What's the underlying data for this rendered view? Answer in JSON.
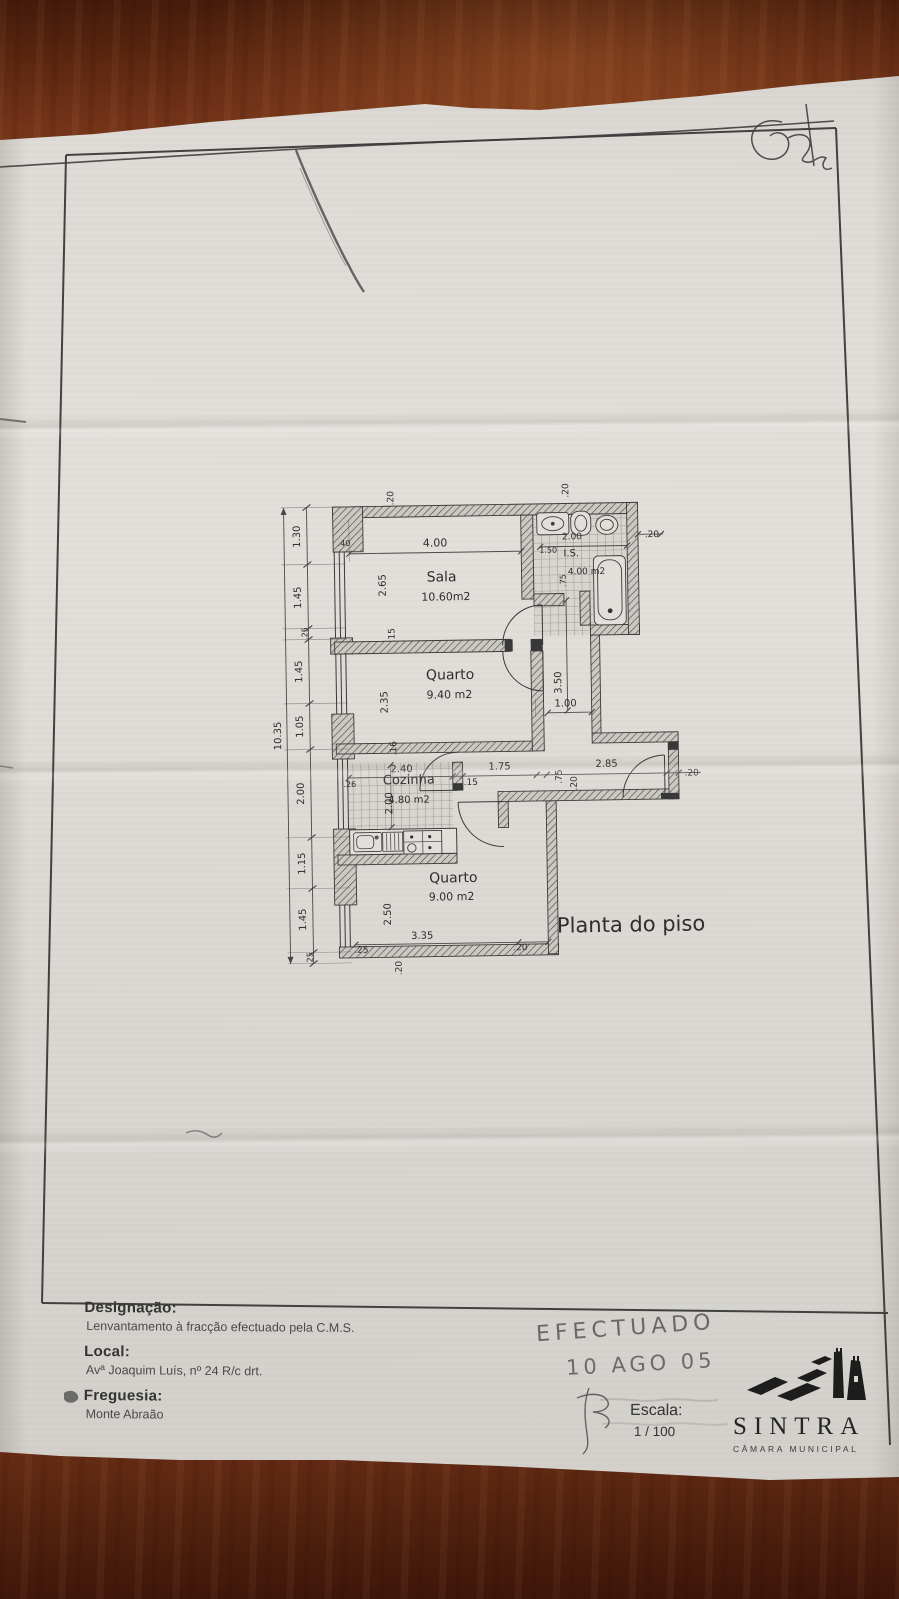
{
  "plan": {
    "title": "Planta do piso",
    "rooms": [
      {
        "name": "Sala",
        "area": "10.60m2"
      },
      {
        "name": "Quarto",
        "area": "9.40 m2"
      },
      {
        "name": "I.S.",
        "area": "4.00 m2"
      },
      {
        "name": "Cozinha",
        "area": "4.80 m2"
      },
      {
        "name": "Quarto",
        "area": "9.00 m2"
      }
    ],
    "left_dimension_chain": [
      "1.30",
      "1.45",
      ".25",
      "1.45",
      "1.05",
      "2.00",
      "1.15",
      "1.45",
      ".25"
    ],
    "left_total": "10.35",
    "labels": [
      {
        "t": ".20",
        "x": 397,
        "y": 497,
        "r": -90,
        "s": 9
      },
      {
        "t": ".40",
        "x": 347,
        "y": 544,
        "r": 0,
        "s": 8
      },
      {
        "t": "4.00",
        "x": 438,
        "y": 546,
        "r": 0,
        "s": 11
      },
      {
        "t": "2.65",
        "x": 388,
        "y": 584,
        "r": -90,
        "s": 10
      },
      {
        "t": "Sala",
        "x": 444,
        "y": 581,
        "r": 0,
        "s": 14
      },
      {
        "t": "10.60m2",
        "x": 448,
        "y": 600,
        "r": 0,
        "s": 11
      },
      {
        "t": ".15",
        "x": 396,
        "y": 634,
        "r": -90,
        "s": 9
      },
      {
        "t": "Quarto",
        "x": 451,
        "y": 679,
        "r": 0,
        "s": 14
      },
      {
        "t": "9.40 m2",
        "x": 450,
        "y": 698,
        "r": 0,
        "s": 11
      },
      {
        "t": "2.35",
        "x": 388,
        "y": 701,
        "r": -90,
        "s": 10
      },
      {
        "t": ".16",
        "x": 396,
        "y": 747,
        "r": -90,
        "s": 9
      },
      {
        "t": ".20",
        "x": 572,
        "y": 492,
        "r": -90,
        "s": 9
      },
      {
        "t": "2.00",
        "x": 575,
        "y": 541,
        "r": 0,
        "s": 9
      },
      {
        "t": "1.50",
        "x": 551,
        "y": 554,
        "r": 0,
        "s": 8
      },
      {
        "t": "I.S.",
        "x": 574,
        "y": 558,
        "r": 0,
        "s": 10
      },
      {
        "t": "4.00 m2",
        "x": 589,
        "y": 576,
        "r": 0,
        "s": 9
      },
      {
        "t": ".20",
        "x": 655,
        "y": 540,
        "r": 0,
        "s": 9
      },
      {
        "t": ".75",
        "x": 568,
        "y": 582,
        "r": -90,
        "s": 8
      },
      {
        "t": "3.50",
        "x": 562,
        "y": 684,
        "r": -90,
        "s": 10
      },
      {
        "t": "1.00",
        "x": 566,
        "y": 708,
        "r": 0,
        "s": 10
      },
      {
        "t": "2.40",
        "x": 401,
        "y": 771,
        "r": 0,
        "s": 10
      },
      {
        "t": ".26",
        "x": 349,
        "y": 785,
        "r": 0,
        "s": 8
      },
      {
        "t": "Cozinha",
        "x": 408,
        "y": 783,
        "r": 0,
        "s": 13
      },
      {
        "t": "2.00",
        "x": 391,
        "y": 802,
        "r": -90,
        "s": 10
      },
      {
        "t": "4.80 m2",
        "x": 408,
        "y": 802,
        "r": 0,
        "s": 10
      },
      {
        "t": "1.75",
        "x": 499,
        "y": 770,
        "r": 0,
        "s": 10
      },
      {
        "t": ".15",
        "x": 470,
        "y": 785,
        "r": 0,
        "s": 9
      },
      {
        "t": ".75",
        "x": 561,
        "y": 778,
        "r": -90,
        "s": 9
      },
      {
        "t": "2.85",
        "x": 606,
        "y": 769,
        "r": 0,
        "s": 10
      },
      {
        "t": ".20",
        "x": 576,
        "y": 785,
        "r": -90,
        "s": 9
      },
      {
        "t": ".20",
        "x": 691,
        "y": 779,
        "r": 0,
        "s": 9
      },
      {
        "t": "Quarto",
        "x": 451,
        "y": 882,
        "r": 0,
        "s": 14
      },
      {
        "t": "9.00 m2",
        "x": 449,
        "y": 900,
        "r": 0,
        "s": 11
      },
      {
        "t": "2.50",
        "x": 388,
        "y": 913,
        "r": -90,
        "s": 10
      },
      {
        "t": "3.35",
        "x": 419,
        "y": 938,
        "r": 0,
        "s": 10
      },
      {
        "t": ".25",
        "x": 358,
        "y": 951,
        "r": 0,
        "s": 9
      },
      {
        "t": ".20",
        "x": 517,
        "y": 951,
        "r": 0,
        "s": 9
      },
      {
        "t": ".20",
        "x": 398,
        "y": 967,
        "r": -90,
        "s": 9
      },
      {
        "t": "1.30",
        "x": 303,
        "y": 534,
        "r": -90,
        "s": 10
      },
      {
        "t": "1.45",
        "x": 303,
        "y": 595,
        "r": -90,
        "s": 10
      },
      {
        "t": ".25",
        "x": 309,
        "y": 631,
        "r": -90,
        "s": 8
      },
      {
        "t": "1.45",
        "x": 303,
        "y": 669,
        "r": -90,
        "s": 10
      },
      {
        "t": "1.05",
        "x": 303,
        "y": 724,
        "r": -90,
        "s": 10
      },
      {
        "t": "2.00",
        "x": 303,
        "y": 791,
        "r": -90,
        "s": 10
      },
      {
        "t": "1.15",
        "x": 303,
        "y": 861,
        "r": -90,
        "s": 10
      },
      {
        "t": "1.45",
        "x": 303,
        "y": 917,
        "r": -90,
        "s": 10
      },
      {
        "t": ".25",
        "x": 309,
        "y": 956,
        "r": -90,
        "s": 8
      },
      {
        "t": "10.35",
        "x": 281,
        "y": 733,
        "r": -90,
        "s": 10
      },
      {
        "t": "Planta do piso",
        "x": 628,
        "y": 934,
        "r": 0,
        "s": 21
      }
    ]
  },
  "titleblock": {
    "designacao_label": "Designação:",
    "designacao_value": "Lenvantamento à fracção efectuado pela C.M.S.",
    "local_label": "Local:",
    "local_value": "Avª Joaquim Luís, nº 24 R/c drt.",
    "freguesia_label": "Freguesia:",
    "freguesia_value": "Monte Abraão",
    "escala_label": "Escala:",
    "escala_value": "1 / 100"
  },
  "handwriting": {
    "stamp_line1": "EFECTUADO",
    "stamp_line2": "10 AGO 05"
  },
  "logo": {
    "city": "SINTRA",
    "org": "CÂMARA MUNICIPAL"
  }
}
